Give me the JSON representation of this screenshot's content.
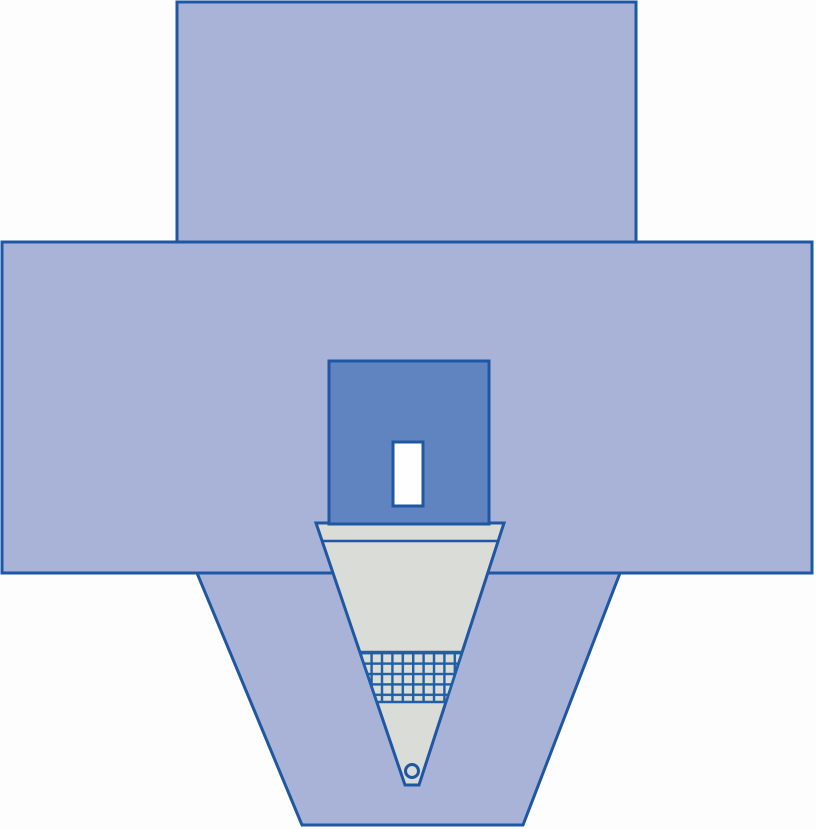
{
  "illustration": {
    "subject": "surgical-drape-with-fluid-collection-pouch",
    "parts": [
      "drape-top-panel",
      "drape-main-panel",
      "drape-lower-panel",
      "fluid-collection-pouch",
      "pouch-fold-line",
      "pouch-filter-mesh",
      "pouch-drain-port",
      "reinforcement-patch",
      "fenestration-opening"
    ]
  },
  "colors": {
    "background": "#fdfdfd",
    "drape_fill": "#a9b3d8",
    "outline": "#1f57a2",
    "reinforcement_fill": "#6084bf",
    "pouch_fill": "#dadcd8",
    "fenestration_fill": "#fefefe",
    "mesh_line": "#1f5fa8",
    "mesh_cell": "#dadcd8"
  }
}
